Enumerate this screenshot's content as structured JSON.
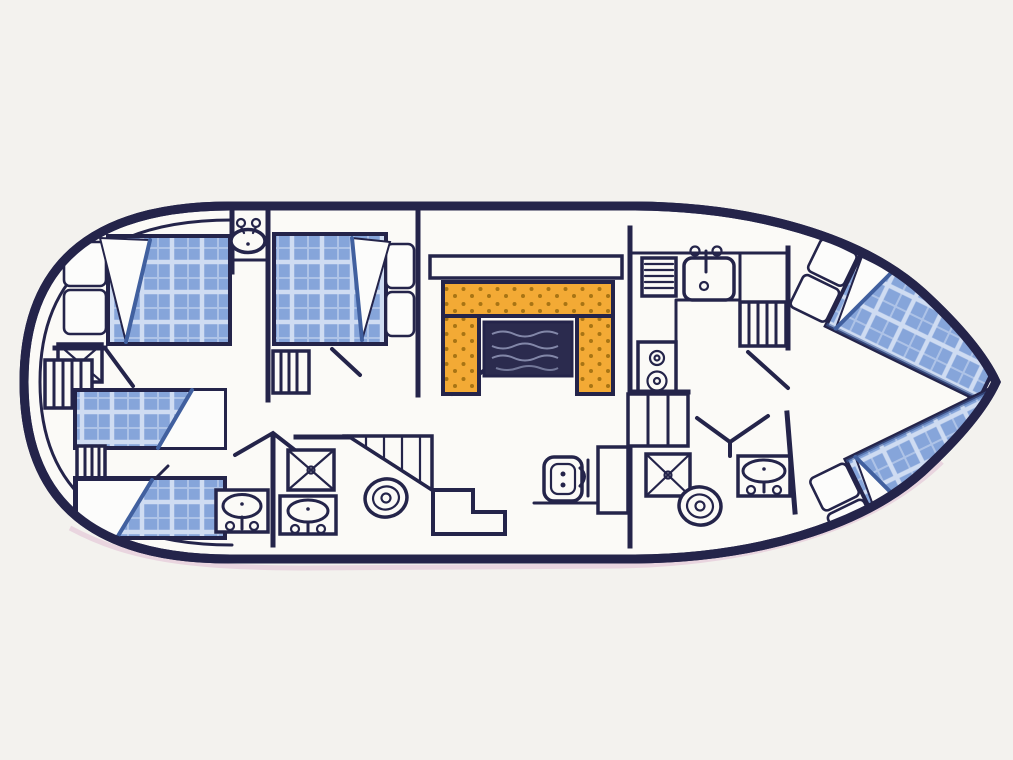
{
  "diagram": {
    "type": "boat-deck-floor-plan",
    "view": "top-down",
    "bow_direction": "right",
    "rooms": [
      {
        "name": "aft-cabin",
        "fixtures": [
          "double-bed",
          "two-pillows",
          "wash-basin",
          "wardrobe",
          "boarding-ladder"
        ]
      },
      {
        "name": "port-guest-cabin",
        "fixtures": [
          "single-bed",
          "single-bed",
          "bunk-ladder",
          "vanity-basin"
        ]
      },
      {
        "name": "mid-cabin",
        "fixtures": [
          "double-bed",
          "two-pillows",
          "cabin-ladder"
        ]
      },
      {
        "name": "aft-bathroom",
        "fixtures": [
          "shower",
          "wash-basin",
          "toilet",
          "double-door"
        ]
      },
      {
        "name": "saloon",
        "fixtures": [
          "u-shaped-settee",
          "dining-table",
          "sideboard",
          "helm-seat",
          "console",
          "staircase",
          "landing-step"
        ]
      },
      {
        "name": "galley",
        "fixtures": [
          "sink",
          "drainer-vent",
          "two-burner-stove",
          "cabinet",
          "companionway-ladder"
        ]
      },
      {
        "name": "forward-bathroom",
        "fixtures": [
          "shower",
          "toilet",
          "wash-basin",
          "double-door"
        ]
      },
      {
        "name": "bow-cabin",
        "fixtures": [
          "v-berth-starboard",
          "v-berth-port",
          "berth-pillows"
        ]
      }
    ],
    "bed_count": 6,
    "bathroom_count": 2
  },
  "colors": {
    "ink": "#24244a",
    "paper": "#f3f2ee",
    "floor": "#fbfaf7",
    "bed_blue": "#86a5da",
    "bed_grid": "#cfdcf2",
    "bed_dark": "#41609f",
    "pillow": "#fcfcfb",
    "sheet_grey": "#dde3ed",
    "settee": "#f3aa35",
    "settee_dot": "#a87414",
    "table": "#2b2b4e",
    "table_streak": "#9298b8",
    "fringe": "#d9a9c9"
  }
}
